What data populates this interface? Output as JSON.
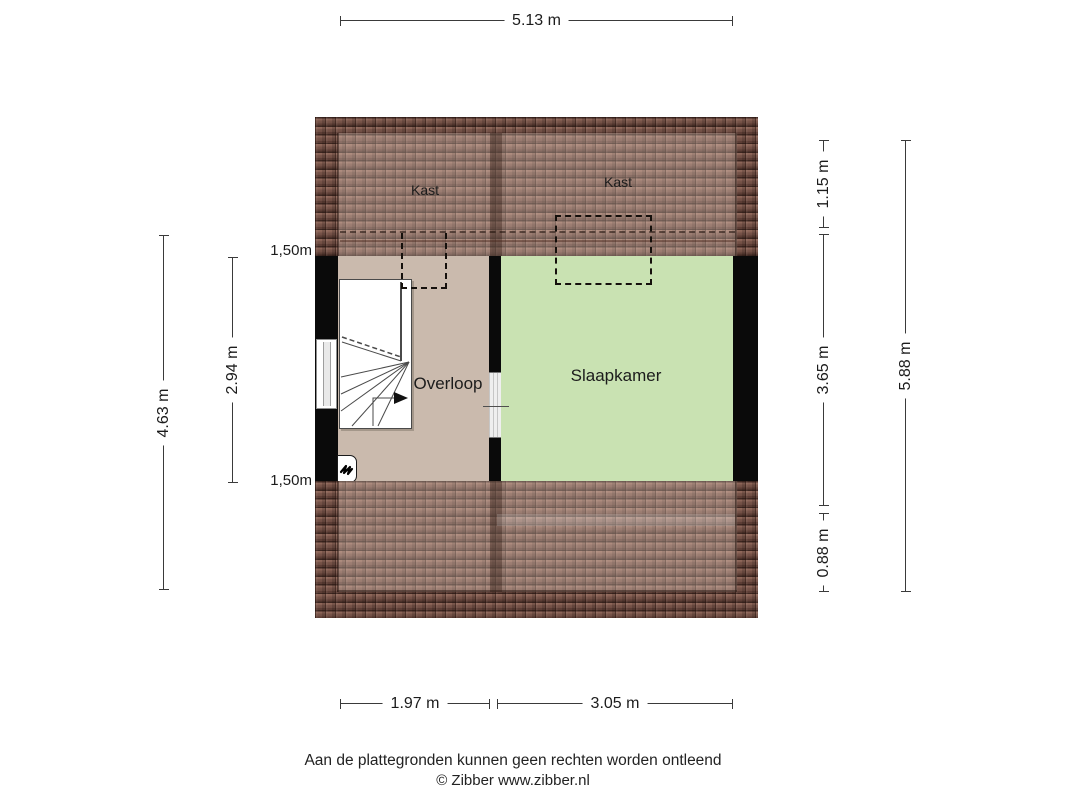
{
  "rooms": {
    "kast_left": "Kast",
    "kast_right": "Kast",
    "overloop": "Overloop",
    "slaapkamer": "Slaapkamer"
  },
  "dims": {
    "top_width": "5.13 m",
    "left_outer": "4.63 m",
    "left_inner": "2.94 m",
    "clearance_top": "1,50m",
    "clearance_bottom": "1,50m",
    "right_upper": "1.15 m",
    "right_middle": "3.65 m",
    "right_lower": "0.88 m",
    "right_outer": "5.88 m",
    "bottom_left": "1.97 m",
    "bottom_right": "3.05 m"
  },
  "footer": {
    "disclaimer": "Aan de plattegronden kunnen geen rechten worden ontleend",
    "copyright": "© Zibber www.zibber.nl"
  },
  "icons": {
    "ventilation_unit": "squiggle-icon",
    "stairs_direction": "arrow-right-icon"
  },
  "colors": {
    "wall": "#0a0a0a",
    "overloop_floor": "#cabaad",
    "slaapkamer_floor": "#c9e2b2",
    "roof_tile": "#96705f",
    "roof_tile_dark": "#3c2823",
    "dim_line": "#3a3a3a",
    "text": "#1c1c1c"
  }
}
